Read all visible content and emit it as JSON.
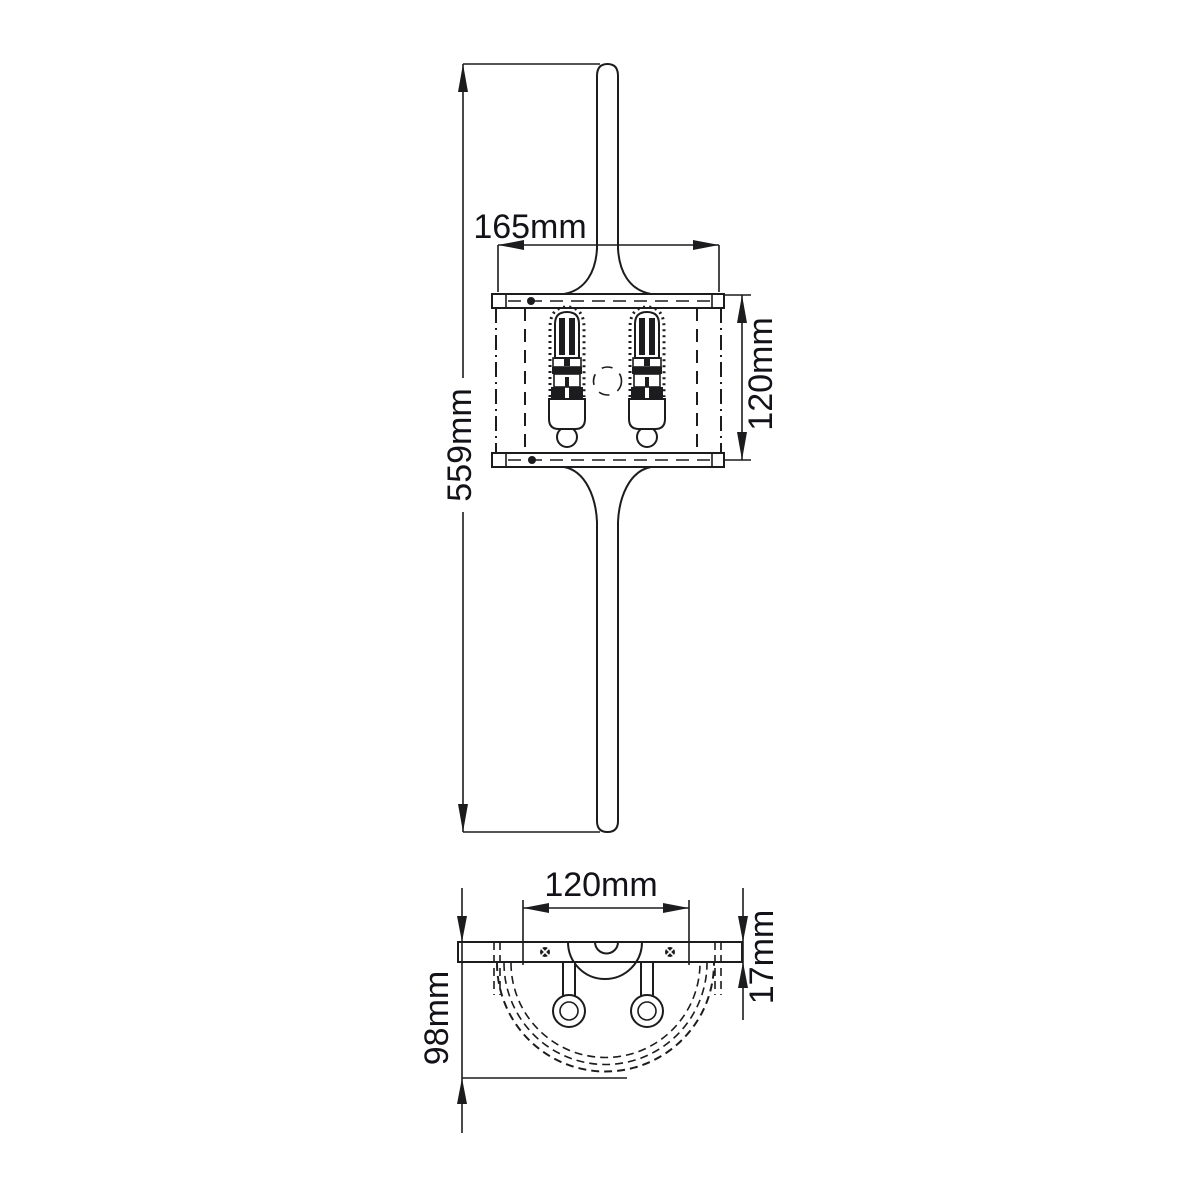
{
  "drawing": {
    "type": "technical-dimension-drawing",
    "subject": "two-lamp half-round wall light, front elevation and plan view",
    "units": "mm"
  },
  "dims": {
    "front_width": "165mm",
    "front_total_height": "559mm",
    "front_shade_height": "120mm",
    "plan_fixing_width": "120mm",
    "plan_plate_depth": "17mm",
    "plan_total_depth": "98mm"
  },
  "colors": {
    "background": "#ffffff",
    "line": "#1c1c1e",
    "text": "#121218"
  }
}
